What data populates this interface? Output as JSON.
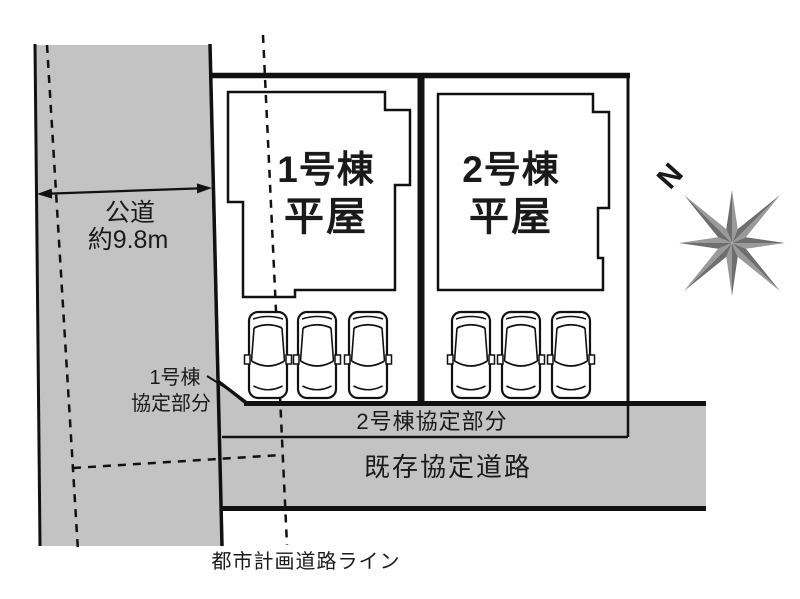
{
  "colors": {
    "road_gray": "#c3c3c3",
    "lot_green": "#a8cdbb",
    "building_beige": "#eae2cf",
    "red": "#e3000f",
    "compass_dark": "#6e6e6e",
    "compass_light": "#9a9a9a",
    "compass_n": "#4d4d4d"
  },
  "public_road": {
    "name": "公道",
    "width_label": "約9.8m"
  },
  "lots": [
    {
      "name": "1号棟",
      "type": "平屋"
    },
    {
      "name": "2号棟",
      "type": "平屋"
    }
  ],
  "parking": {
    "lot1_spaces": 3,
    "lot2_spaces": 3
  },
  "agreement": {
    "lot1_line1": "1号棟",
    "lot1_line2": "協定部分",
    "lot2": "2号棟協定部分"
  },
  "existing_road": "既存協定道路",
  "planning_road_line": "都市計画道路ライン",
  "compass": {
    "north": "N"
  }
}
